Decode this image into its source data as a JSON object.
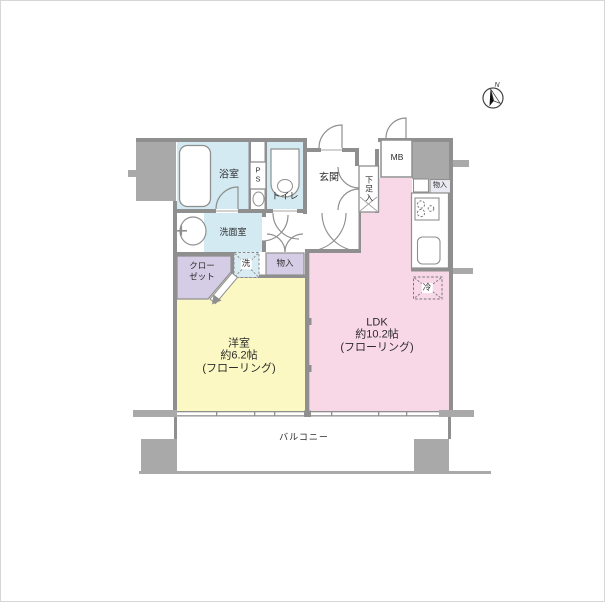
{
  "plan": {
    "compass": {
      "label": "N"
    },
    "rooms": {
      "bathroom": {
        "label": "浴室"
      },
      "pipe_space": {
        "line1": "P",
        "line2": "S"
      },
      "toilet": {
        "label": "トイレ"
      },
      "entrance": {
        "label": "玄関"
      },
      "shoe_cabinet": {
        "label": "下足入"
      },
      "meter_box": {
        "label": "MB"
      },
      "storage_kitchen": {
        "label": "物入"
      },
      "washroom": {
        "label": "洗面室"
      },
      "washer": {
        "label": "洗"
      },
      "storage_hall": {
        "label": "物入"
      },
      "closet": {
        "line1": "クロー",
        "line2": "ゼット"
      },
      "refrigerator": {
        "label": "冷"
      },
      "western_room": {
        "name": "洋室",
        "size": "約6.2帖",
        "flooring": "(フローリング)"
      },
      "ldk": {
        "name": "LDK",
        "size": "約10.2帖",
        "flooring": "(フローリング)"
      },
      "balcony": {
        "label": "バルコニー"
      }
    },
    "colors": {
      "wall": "#8f8f8f",
      "wall_block": "#a9a9a9",
      "wet_area_blue": "#d3eaf2",
      "western_room_yellow": "#fbf8c3",
      "ldk_pink": "#f8d8e6",
      "storage_purple": "#d5cde5",
      "label_box_gray": "#e9e9f1"
    }
  }
}
